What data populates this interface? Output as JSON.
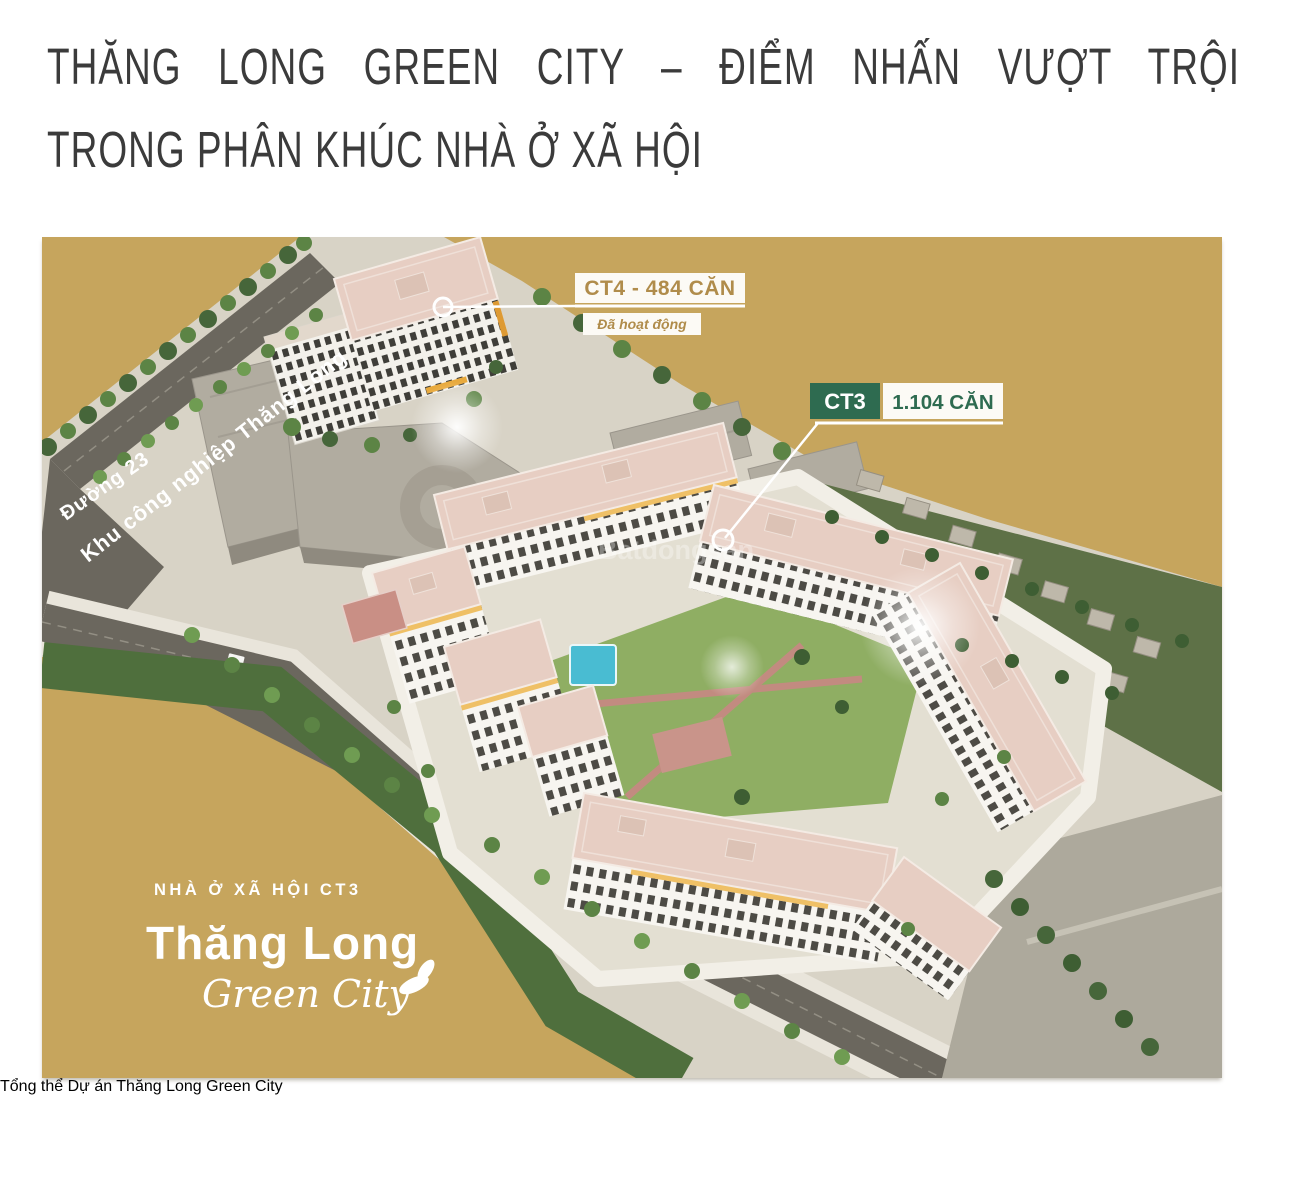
{
  "article": {
    "heading_line1": "THĂNG LONG GREEN CITY – ĐIỂM NHẤN VƯỢT TRỘI",
    "heading_line2": "TRONG PHÂN KHÚC NHÀ Ở XÃ HỘI",
    "caption": "Tổng thể Dự án Thăng Long Green City"
  },
  "masterplan": {
    "ct4_label": "CT4 - 484 CĂN",
    "ct4_status": "Đã hoạt động",
    "ct3_code": "CT3",
    "ct3_units": "1.104 CĂN",
    "road_label_industrial": "Khu công nghiệp Thăng Long",
    "road_label_23": "Đường 23",
    "watermark": "Batdongsan",
    "logo": {
      "tagline": "NHÀ Ở XÃ HỘI CT3",
      "name": "Thăng Long",
      "subname": "Green City"
    },
    "colors": {
      "background_gold": "#C6A55D",
      "label_gold_text": "#B08C4B",
      "label_green": "#2E6B50",
      "roof_salmon": "#E7CEC3",
      "pool_teal": "#49BCD2"
    }
  }
}
